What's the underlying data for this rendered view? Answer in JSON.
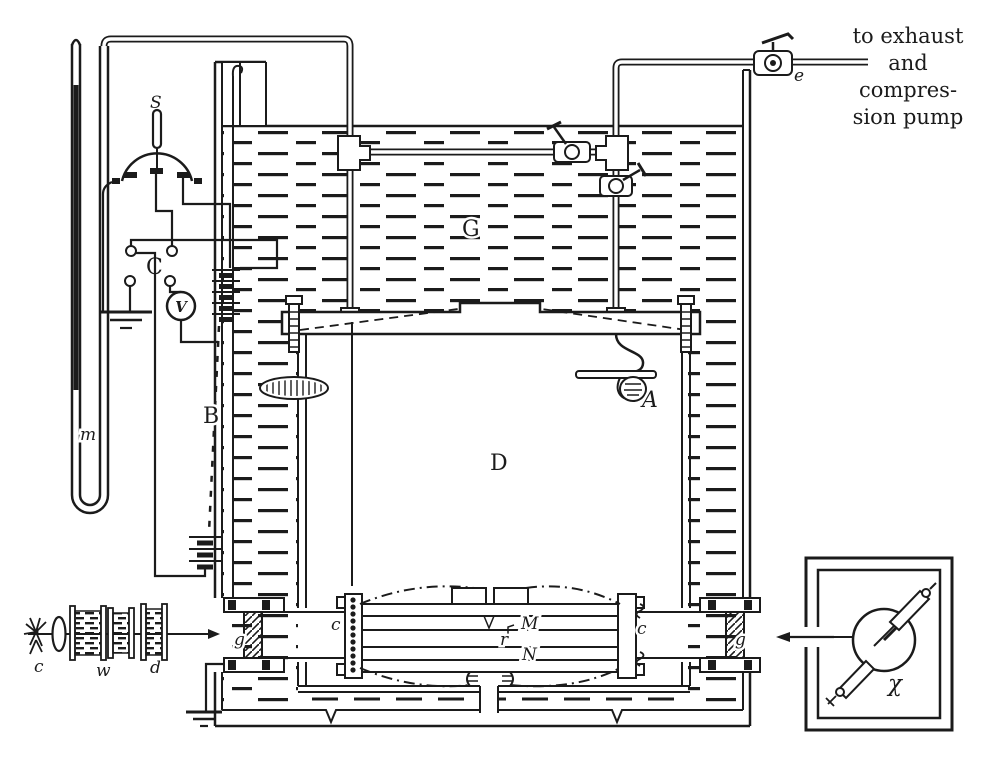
{
  "colors": {
    "ink": "#1b1b1b",
    "paper": "#ffffff"
  },
  "figure": {
    "labels": {
      "manometer": "m",
      "switch": "S",
      "commutator": "C",
      "voltmeter": "V",
      "battery": "B",
      "oil_bath": "G",
      "chamber": "D",
      "atomizer": "A",
      "upper_plate": "M",
      "lower_plate": "N",
      "pinhole": "r",
      "post_left": "c",
      "post_right": "c",
      "window_left": "g",
      "window_right": "g",
      "exhaust_valve": "e",
      "arc_lamp": "c",
      "water_cell": "w",
      "filter_cell": "d",
      "xray_tube": "χ"
    },
    "annotation": {
      "line1": "to exhaust",
      "line2": "and",
      "line3": "compres-",
      "line4": "sion pump"
    }
  }
}
